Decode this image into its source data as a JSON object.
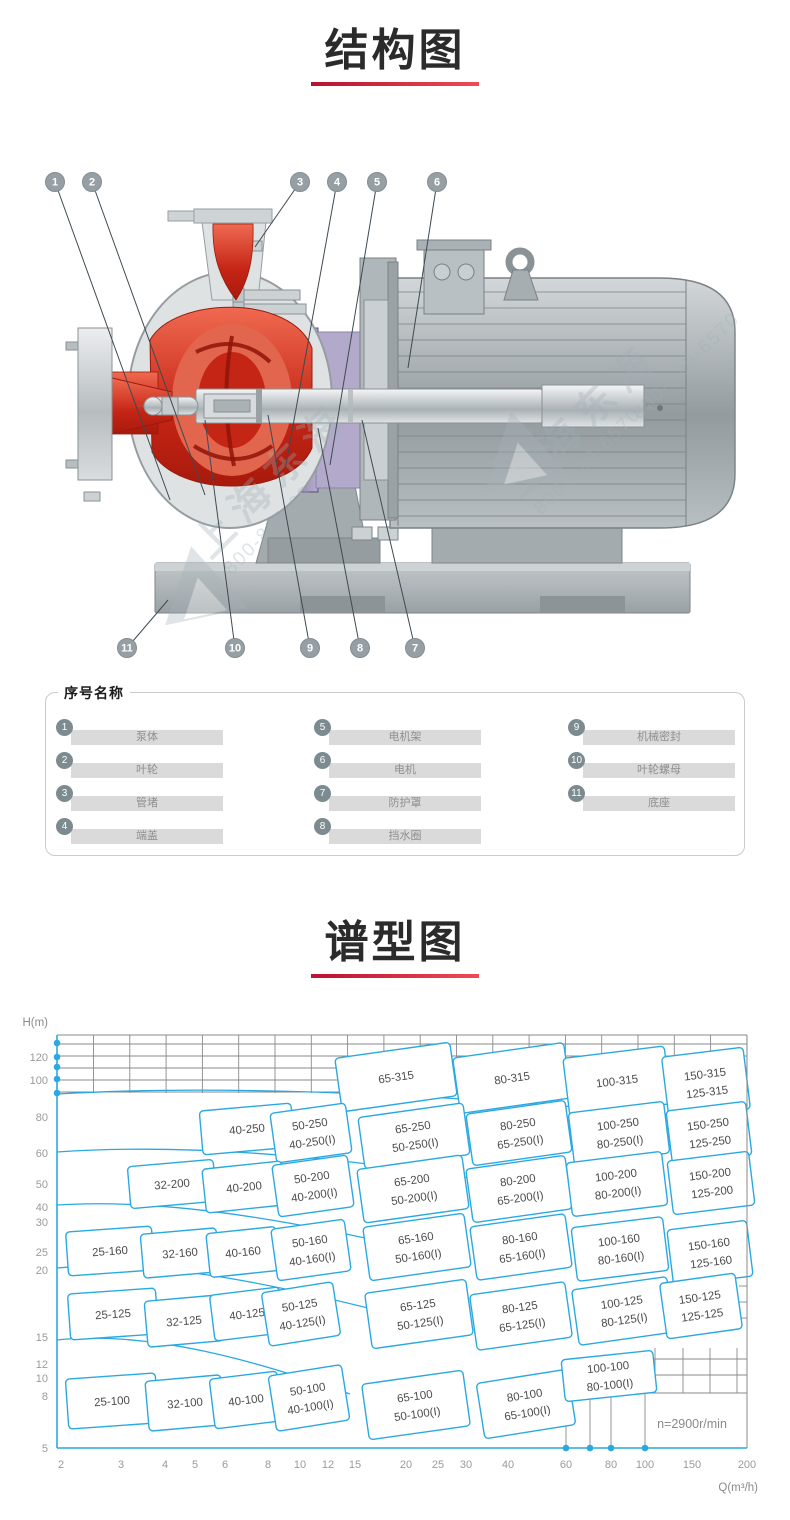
{
  "section1": {
    "title": "结构图"
  },
  "section2": {
    "title": "谱型图"
  },
  "diagram": {
    "watermark": {
      "brand": "上海东海",
      "phone": "800-820-6570"
    },
    "callouts": [
      {
        "n": "1",
        "x": 55,
        "y": 182,
        "tx": 170,
        "ty": 500
      },
      {
        "n": "2",
        "x": 92,
        "y": 182,
        "tx": 205,
        "ty": 495
      },
      {
        "n": "3",
        "x": 300,
        "y": 182,
        "tx": 255,
        "ty": 247
      },
      {
        "n": "4",
        "x": 337,
        "y": 182,
        "tx": 285,
        "ty": 470
      },
      {
        "n": "5",
        "x": 377,
        "y": 182,
        "tx": 330,
        "ty": 465
      },
      {
        "n": "6",
        "x": 437,
        "y": 182,
        "tx": 408,
        "ty": 368
      },
      {
        "n": "11",
        "x": 127,
        "y": 648,
        "tx": 168,
        "ty": 600
      },
      {
        "n": "10",
        "x": 235,
        "y": 648,
        "tx": 205,
        "ty": 420
      },
      {
        "n": "9",
        "x": 310,
        "y": 648,
        "tx": 268,
        "ty": 415
      },
      {
        "n": "8",
        "x": 360,
        "y": 648,
        "tx": 318,
        "ty": 428
      },
      {
        "n": "7",
        "x": 415,
        "y": 648,
        "tx": 362,
        "ty": 420
      }
    ]
  },
  "legend": {
    "title": "序号名称",
    "columns": [
      [
        {
          "no": "1",
          "name": "泵体"
        },
        {
          "no": "2",
          "name": "叶轮"
        },
        {
          "no": "3",
          "name": "管堵"
        },
        {
          "no": "4",
          "name": "端盖"
        }
      ],
      [
        {
          "no": "5",
          "name": "电机架"
        },
        {
          "no": "6",
          "name": "电机"
        },
        {
          "no": "7",
          "name": "防护罩"
        },
        {
          "no": "8",
          "name": "挡水圈"
        }
      ],
      [
        {
          "no": "9",
          "name": "机械密封"
        },
        {
          "no": "10",
          "name": "叶轮螺母"
        },
        {
          "no": "11",
          "name": "底座"
        }
      ]
    ]
  },
  "chart_data": {
    "type": "region-map pump selection chart",
    "title": "谱型图",
    "xlabel": "Q(m³/h)",
    "ylabel": "H(m)",
    "x_scale": "log",
    "y_scale": "log",
    "xlim": [
      2,
      200
    ],
    "ylim": [
      5,
      140
    ],
    "note": "n=2900r/min",
    "accent_color": "#2aa9e1",
    "grid_color": "#8a8a8a",
    "x_ticks": [
      {
        "v": "2",
        "px": 61
      },
      {
        "v": "3",
        "px": 121
      },
      {
        "v": "4",
        "px": 165
      },
      {
        "v": "5",
        "px": 195
      },
      {
        "v": "6",
        "px": 225
      },
      {
        "v": "8",
        "px": 268
      },
      {
        "v": "10",
        "px": 300
      },
      {
        "v": "12",
        "px": 328
      },
      {
        "v": "15",
        "px": 355
      },
      {
        "v": "20",
        "px": 406
      },
      {
        "v": "25",
        "px": 438
      },
      {
        "v": "30",
        "px": 466
      },
      {
        "v": "40",
        "px": 508
      },
      {
        "v": "60",
        "px": 566
      },
      {
        "v": "80",
        "px": 611
      },
      {
        "v": "100",
        "px": 645
      },
      {
        "v": "150",
        "px": 692
      },
      {
        "v": "200",
        "px": 747
      }
    ],
    "y_ticks": [
      {
        "v": "120",
        "px": 1057
      },
      {
        "v": "100",
        "px": 1080
      },
      {
        "v": "80",
        "px": 1117
      },
      {
        "v": "60",
        "px": 1153
      },
      {
        "v": "50",
        "px": 1184
      },
      {
        "v": "40",
        "px": 1207
      },
      {
        "v": "30",
        "px": 1222
      },
      {
        "v": "25",
        "px": 1252
      },
      {
        "v": "20",
        "px": 1270
      },
      {
        "v": "15",
        "px": 1337
      },
      {
        "v": "12",
        "px": 1364
      },
      {
        "v": "10",
        "px": 1378
      },
      {
        "v": "8",
        "px": 1396
      },
      {
        "v": "5",
        "px": 1448
      }
    ],
    "axis_dots_left_px": [
      1043,
      1057,
      1067,
      1079,
      1093
    ],
    "axis_dots_bottom_px": [
      566,
      590,
      611,
      645
    ],
    "models": [
      {
        "n": "65-315",
        "n2": "",
        "x": 396,
        "y": 1077,
        "w": 116,
        "h": 54,
        "r": -8
      },
      {
        "n": "80-315",
        "n2": "",
        "x": 512,
        "y": 1078,
        "w": 112,
        "h": 56,
        "r": -8
      },
      {
        "n": "100-315",
        "n2": "",
        "x": 617,
        "y": 1081,
        "w": 102,
        "h": 58,
        "r": -7
      },
      {
        "n": "150-315",
        "n2": "125-315",
        "x": 706,
        "y": 1083,
        "w": 82,
        "h": 62,
        "r": -7
      },
      {
        "n": "40-250",
        "n2": "",
        "x": 247,
        "y": 1129,
        "w": 92,
        "h": 44,
        "r": -5
      },
      {
        "n": "50-250",
        "n2": "40-250(I)",
        "x": 311,
        "y": 1133,
        "w": 76,
        "h": 50,
        "r": -8
      },
      {
        "n": "65-250",
        "n2": "50-250(I)",
        "x": 414,
        "y": 1136,
        "w": 106,
        "h": 52,
        "r": -8
      },
      {
        "n": "80-250",
        "n2": "65-250(I)",
        "x": 519,
        "y": 1133,
        "w": 100,
        "h": 52,
        "r": -8
      },
      {
        "n": "100-250",
        "n2": "80-250(I)",
        "x": 619,
        "y": 1133,
        "w": 96,
        "h": 52,
        "r": -7
      },
      {
        "n": "150-250",
        "n2": "125-250",
        "x": 709,
        "y": 1133,
        "w": 80,
        "h": 54,
        "r": -7
      },
      {
        "n": "32-200",
        "n2": "",
        "x": 172,
        "y": 1184,
        "w": 86,
        "h": 42,
        "r": -5
      },
      {
        "n": "40-200",
        "n2": "",
        "x": 244,
        "y": 1187,
        "w": 80,
        "h": 44,
        "r": -6
      },
      {
        "n": "50-200",
        "n2": "40-200(I)",
        "x": 313,
        "y": 1186,
        "w": 76,
        "h": 52,
        "r": -8
      },
      {
        "n": "65-200",
        "n2": "50-200(I)",
        "x": 413,
        "y": 1189,
        "w": 106,
        "h": 54,
        "r": -8
      },
      {
        "n": "80-200",
        "n2": "65-200(I)",
        "x": 519,
        "y": 1189,
        "w": 100,
        "h": 54,
        "r": -8
      },
      {
        "n": "100-200",
        "n2": "80-200(I)",
        "x": 617,
        "y": 1184,
        "w": 96,
        "h": 54,
        "r": -7
      },
      {
        "n": "150-200",
        "n2": "125-200",
        "x": 711,
        "y": 1183,
        "w": 82,
        "h": 54,
        "r": -7
      },
      {
        "n": "25-160",
        "n2": "",
        "x": 110,
        "y": 1251,
        "w": 86,
        "h": 44,
        "r": -4
      },
      {
        "n": "32-160",
        "n2": "",
        "x": 180,
        "y": 1253,
        "w": 76,
        "h": 44,
        "r": -5
      },
      {
        "n": "40-160",
        "n2": "",
        "x": 243,
        "y": 1252,
        "w": 70,
        "h": 44,
        "r": -6
      },
      {
        "n": "50-160",
        "n2": "40-160(I)",
        "x": 311,
        "y": 1250,
        "w": 74,
        "h": 52,
        "r": -8
      },
      {
        "n": "65-160",
        "n2": "50-160(I)",
        "x": 417,
        "y": 1247,
        "w": 102,
        "h": 54,
        "r": -8
      },
      {
        "n": "80-160",
        "n2": "65-160(I)",
        "x": 521,
        "y": 1247,
        "w": 96,
        "h": 54,
        "r": -8
      },
      {
        "n": "100-160",
        "n2": "80-160(I)",
        "x": 620,
        "y": 1249,
        "w": 92,
        "h": 54,
        "r": -7
      },
      {
        "n": "150-160",
        "n2": "125-160",
        "x": 710,
        "y": 1253,
        "w": 80,
        "h": 56,
        "r": -7
      },
      {
        "n": "25-125",
        "n2": "",
        "x": 113,
        "y": 1314,
        "w": 88,
        "h": 46,
        "r": -4
      },
      {
        "n": "32-125",
        "n2": "",
        "x": 184,
        "y": 1321,
        "w": 76,
        "h": 46,
        "r": -5
      },
      {
        "n": "40-125",
        "n2": "",
        "x": 247,
        "y": 1314,
        "w": 70,
        "h": 46,
        "r": -7
      },
      {
        "n": "50-125",
        "n2": "40-125(I)",
        "x": 301,
        "y": 1314,
        "w": 72,
        "h": 54,
        "r": -9
      },
      {
        "n": "65-125",
        "n2": "50-125(I)",
        "x": 419,
        "y": 1314,
        "w": 102,
        "h": 56,
        "r": -8
      },
      {
        "n": "80-125",
        "n2": "65-125(I)",
        "x": 521,
        "y": 1316,
        "w": 96,
        "h": 56,
        "r": -8
      },
      {
        "n": "100-125",
        "n2": "80-125(I)",
        "x": 623,
        "y": 1311,
        "w": 96,
        "h": 56,
        "r": -8
      },
      {
        "n": "150-125",
        "n2": "125-125",
        "x": 701,
        "y": 1306,
        "w": 76,
        "h": 56,
        "r": -8
      },
      {
        "n": "25-100",
        "n2": "",
        "x": 112,
        "y": 1401,
        "w": 90,
        "h": 50,
        "r": -4
      },
      {
        "n": "32-100",
        "n2": "",
        "x": 185,
        "y": 1403,
        "w": 76,
        "h": 50,
        "r": -5
      },
      {
        "n": "40-100",
        "n2": "",
        "x": 246,
        "y": 1400,
        "w": 68,
        "h": 50,
        "r": -7
      },
      {
        "n": "50-100",
        "n2": "40-100(I)",
        "x": 309,
        "y": 1398,
        "w": 74,
        "h": 56,
        "r": -9
      },
      {
        "n": "65-100",
        "n2": "50-100(I)",
        "x": 416,
        "y": 1405,
        "w": 102,
        "h": 56,
        "r": -8
      },
      {
        "n": "80-100",
        "n2": "65-100(I)",
        "x": 526,
        "y": 1404,
        "w": 92,
        "h": 56,
        "r": -9
      },
      {
        "n": "100-100",
        "n2": "80-100(I)",
        "x": 609,
        "y": 1376,
        "w": 92,
        "h": 42,
        "r": -6
      }
    ]
  }
}
